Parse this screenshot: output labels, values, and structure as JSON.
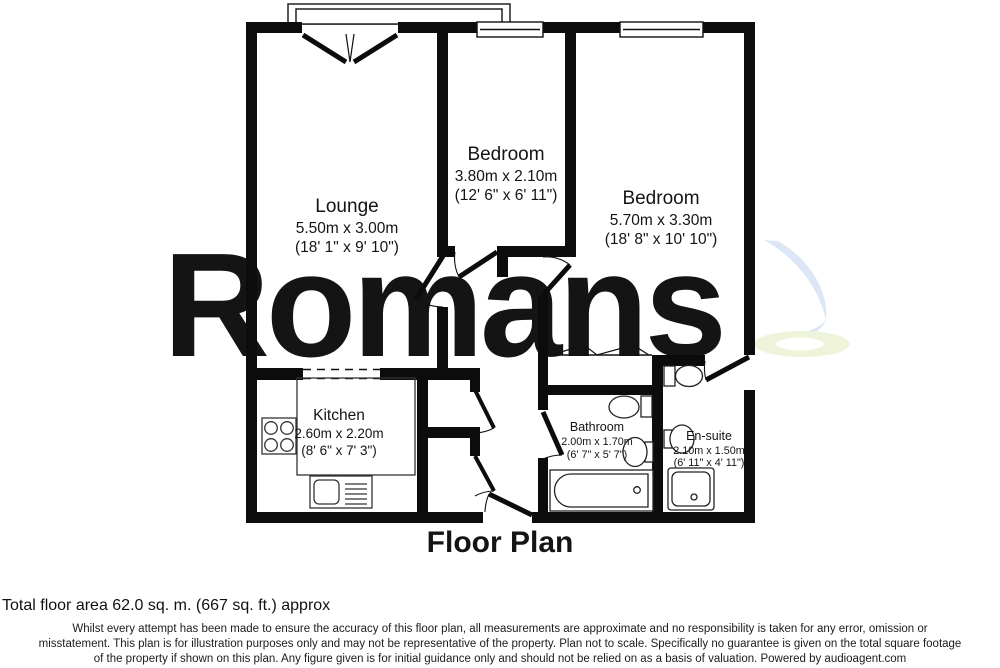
{
  "watermark": {
    "text": "Romans"
  },
  "colors": {
    "wall": "#0c0c0c",
    "watermark_gray": "#e4e4e7",
    "logo_blue": "#dbe7f4",
    "logo_yellow": "#edf4d9"
  },
  "plan": {
    "title": "Floor Plan"
  },
  "rooms": [
    {
      "id": "lounge",
      "name": "Lounge",
      "metric": "5.50m x 3.00m",
      "imperial": "(18' 1\" x 9' 10\")"
    },
    {
      "id": "bedroom-1",
      "name": "Bedroom",
      "metric": "3.80m x 2.10m",
      "imperial": "(12' 6\" x 6' 11\")"
    },
    {
      "id": "bedroom-2",
      "name": "Bedroom",
      "metric": "5.70m x 3.30m",
      "imperial": "(18' 8\" x 10' 10\")"
    },
    {
      "id": "kitchen",
      "name": "Kitchen",
      "metric": "2.60m x 2.20m",
      "imperial": "(8' 6\" x 7' 3\")"
    },
    {
      "id": "bathroom",
      "name": "Bathroom",
      "metric": "2.00m x 1.70m",
      "imperial": "(6' 7\" x 5' 7\")"
    },
    {
      "id": "en-suite",
      "name": "En-suite",
      "metric": "2.10m x 1.50m",
      "imperial": "(6' 11\" x 4' 11\")"
    }
  ],
  "fixtures": [
    "balcony",
    "french-doors",
    "window",
    "wardrobe",
    "kitchen-hob",
    "kitchen-sink",
    "bath",
    "toilet",
    "basin",
    "shower-tray",
    "storage-cupboards",
    "entry-door"
  ],
  "footer": {
    "total_area": "Total floor area 62.0 sq. m. (667 sq. ft.) approx",
    "disclaimer_lines": [
      "Whilst every attempt has been made to ensure the accuracy of this floor plan, all measurements are approximate and no responsibility is taken for any error, omission or",
      "misstatement. This plan is for illustration purposes only and may not be representative of the property. Plan not to scale. Specifically no guarantee is given on the total square footage",
      "of the property if shown on this plan. Any figure given is for initial guidance only and should not be relied on as a basis of valuation. Powered by audioagent.com"
    ]
  }
}
